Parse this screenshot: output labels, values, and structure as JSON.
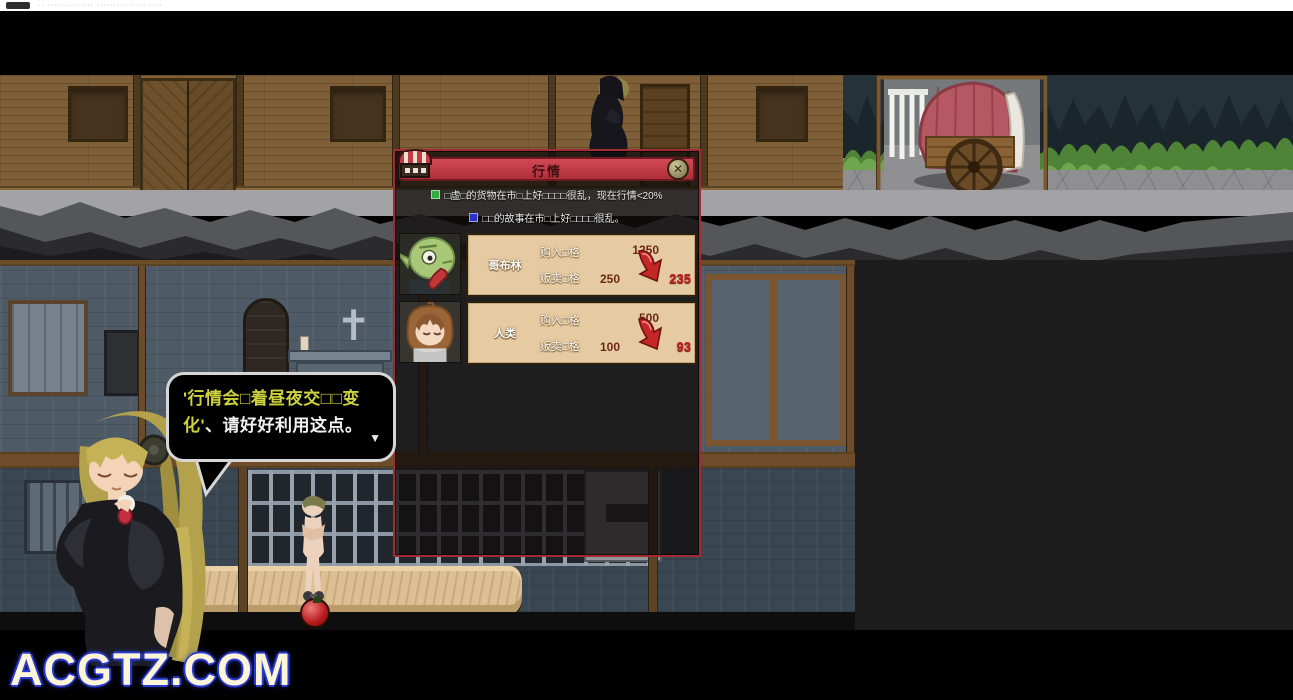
{
  "titlebar": {
    "text": "·· ········· ···· ··········· ··· ····"
  },
  "scene": {
    "watermark": "ACGTZ.COM"
  },
  "market_dialog": {
    "title": "行情",
    "close_label": "✕",
    "info_lines": [
      {
        "icon": "green-cube-icon",
        "text": "□虚□的货物在市□上好□□□□很乱，现在行情<20%"
      },
      {
        "icon": "blue-cube-icon",
        "text": "□□的故事在市□上好□□□□很乱。"
      }
    ],
    "rows": [
      {
        "name": "哥布林",
        "buy_label": "购入□格",
        "buy_value": "1250",
        "sell_label": "贩卖□格",
        "sell_old": "250",
        "sell_new": "235"
      },
      {
        "name": "人类",
        "buy_label": "购入□格",
        "buy_value": "500",
        "sell_label": "贩卖□格",
        "sell_old": "100",
        "sell_new": "93"
      }
    ]
  },
  "speech_bubble": {
    "line1": "'行情会□着昼夜交□□变",
    "line2_highlight": "化'",
    "line2_rest": "、请好好利用这点。",
    "next_indicator": "▼"
  },
  "colors": {
    "header_red": "#c23b44",
    "dialog_border": "#a12a33",
    "panel_tan": "#e6caa2",
    "price_drop_red": "#c42222",
    "price_dark": "#6b2a16",
    "bubble_yellow": "#ced23e",
    "green_icon": "#2fae3f",
    "blue_icon": "#2a35c8",
    "watermark_cream": "#fdf5d8",
    "watermark_glow": "#2a3bd0"
  }
}
